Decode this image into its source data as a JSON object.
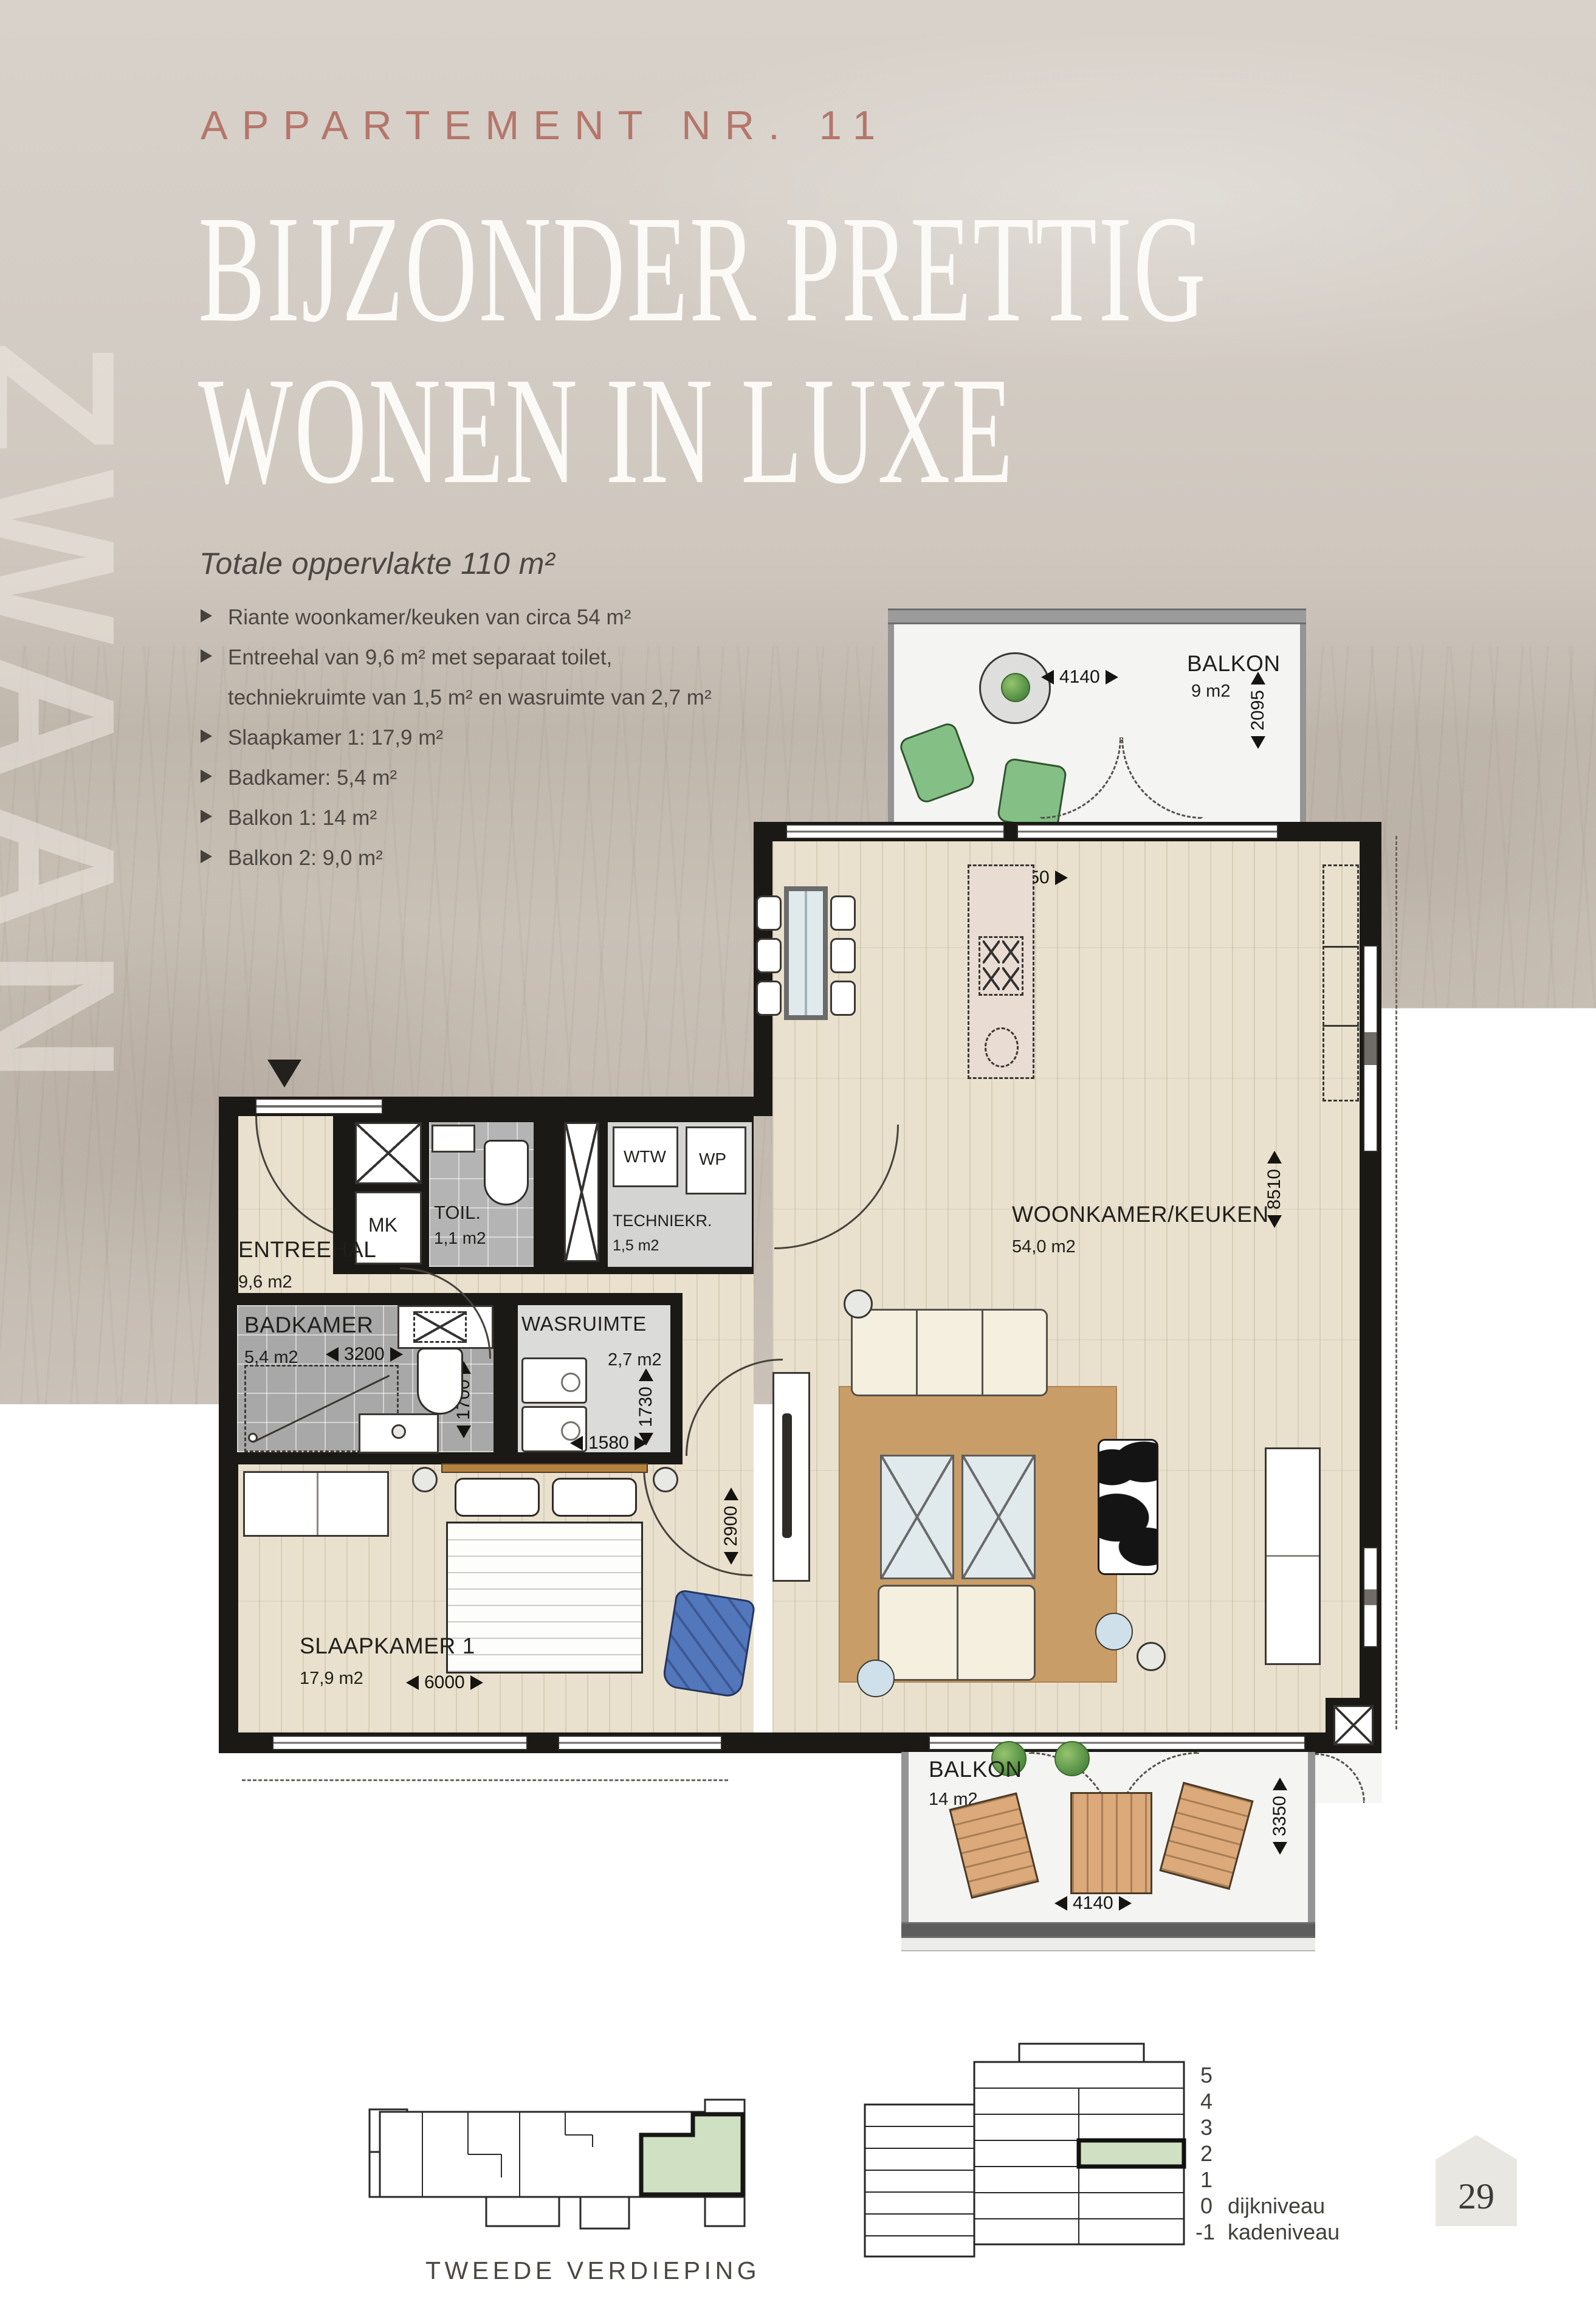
{
  "header": {
    "kicker": "APPARTEMENT NR. 11",
    "title_line1": "BIJZONDER PRETTIG",
    "title_line2": "WONEN IN LUXE",
    "watermark": "ZWAAN",
    "accent_color": "#b5766b"
  },
  "specs": {
    "title": "Totale oppervlakte 110 m²",
    "items": [
      {
        "text": "Riante woonkamer/keuken van circa 54 m²"
      },
      {
        "text": "Entreehal van 9,6 m² met separaat toilet,"
      },
      {
        "text": "techniekruimte van 1,5 m² en wasruimte van 2,7 m²"
      },
      {
        "text": "Slaapkamer 1: 17,9 m²"
      },
      {
        "text": "Badkamer: 5,4 m²"
      },
      {
        "text": "Balkon 1: 14 m²"
      },
      {
        "text": "Balkon 2: 9,0 m²"
      }
    ]
  },
  "plan": {
    "rooms": {
      "balkon_top": {
        "name": "BALKON",
        "area": "9 m2"
      },
      "woonkamer": {
        "name": "WOONKAMER/KEUKEN",
        "area": "54,0 m2"
      },
      "entreehal": {
        "name": "ENTREEHAL",
        "area": "9,6 m2"
      },
      "mk": {
        "name": "MK"
      },
      "toilet": {
        "name": "TOIL.",
        "area": "1,1 m2"
      },
      "techniek": {
        "name": "TECHNIEKR.",
        "area": "1,5 m2",
        "wtw": "WTW",
        "wp": "WP"
      },
      "badkamer": {
        "name": "BADKAMER",
        "area": "5,4 m2"
      },
      "wasruimte": {
        "name": "WASRUIMTE",
        "area": "2,7 m2"
      },
      "slaapkamer": {
        "name": "SLAAPKAMER 1",
        "area": "17,9 m2"
      },
      "balkon_bottom": {
        "name": "BALKON",
        "area": "14 m2"
      }
    },
    "dimensions": {
      "balkon_top_w": "4140",
      "balkon_top_d": "2095",
      "woonkamer_w": "5950",
      "woonkamer_d": "8510",
      "badkamer_w": "3200",
      "badkamer_d": "1700",
      "wasruimte_d": "1730",
      "wasruimte_w": "1580",
      "slaapkamer_w": "6000",
      "slaapkamer_d": "2900",
      "balkon_bottom_w": "4140",
      "balkon_bottom_d": "3350"
    }
  },
  "footer": {
    "siteplan_label": "TWEEDE VERDIEPING",
    "levels": [
      {
        "num": "5",
        "label": ""
      },
      {
        "num": "4",
        "label": ""
      },
      {
        "num": "3",
        "label": ""
      },
      {
        "num": "2",
        "label": ""
      },
      {
        "num": "1",
        "label": ""
      },
      {
        "num": "0",
        "label": "dijkniveau"
      },
      {
        "num": "-1",
        "label": "kadeniveau"
      }
    ],
    "page_number": "29",
    "highlight_color": "#cfe0c3"
  }
}
